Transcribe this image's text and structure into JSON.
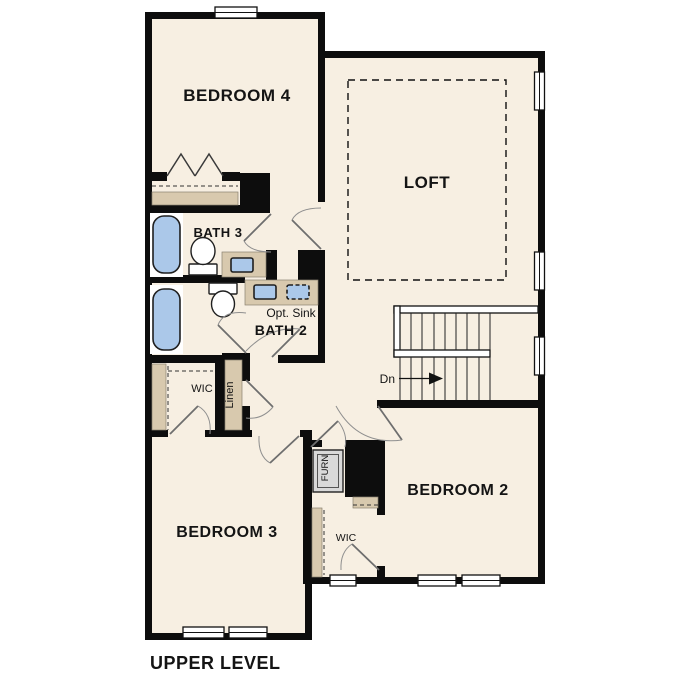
{
  "title": "UPPER LEVEL",
  "rooms": {
    "bedroom4": "BEDROOM 4",
    "loft": "LOFT",
    "bath3": "BATH 3",
    "bath2": "BATH 2",
    "opt_sink": "Opt. Sink",
    "wic_bedroom3": "WIC",
    "linen": "Linen",
    "stairs_down": "Dn",
    "furnace": "FURN",
    "bedroom2": "BEDROOM 2",
    "wic_bedroom2": "WIC",
    "bedroom3": "BEDROOM 3"
  },
  "colors": {
    "floor": "#f7efe2",
    "wall": "#0d0d0d",
    "cabinet_tan": "#d8c9ae",
    "fixture_blue": "#abc8e9",
    "furnace_gray": "#d9d9d9",
    "door_gray": "#6e6e6e",
    "background": "#ffffff"
  }
}
